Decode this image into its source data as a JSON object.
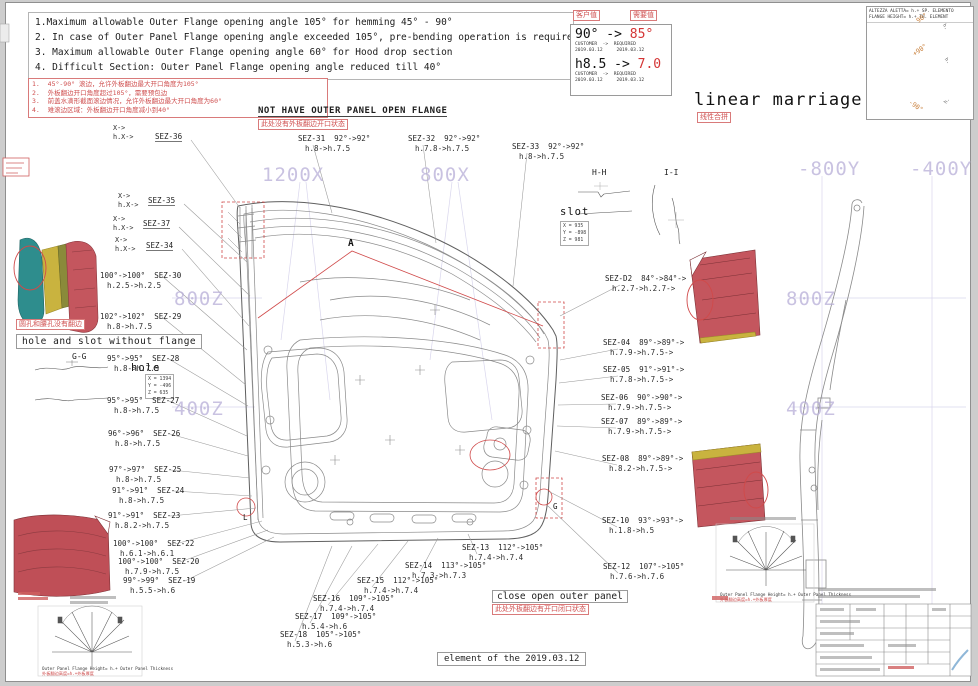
{
  "notes_en": {
    "l1": "1.Maximum allowable Outer Flange opening angle 105° for hemming 45° - 90°",
    "l2": "2. In case of Outer Panel Flange opening angle exceeded 105°, pre-bending operation is required",
    "l3": "3. Maximum allowable Outer Flange opening angle 60° for Hood drop section",
    "l4": "4. Difficult Section: Outer Panel Flange opening angle reduced till 40°"
  },
  "notes_cn": {
    "l1": "1.  45°-90° 滚边，允许外板翻边最大开口角度为105°",
    "l2": "2.  外板翻边开口角度超过105°，需要预包边",
    "l3": "3.  前盖水滴形截面滚边情况，允许外板翻边最大开口角度为60°",
    "l4": "4.  难滚边区域：外板翻边开口角度减小到40°"
  },
  "change_box": {
    "tag_old": "客户值",
    "tag_new": "需要值",
    "angle_old": "90°",
    "angle_arrow": " -> ",
    "angle_new": "85°",
    "meta1": "CUSTOMER  ->  REQUIRED",
    "meta2": "2019.03.12     2019.03.12",
    "height_old": "h8.5",
    "height_arrow": " -> ",
    "height_new": "7.0"
  },
  "titles": {
    "linear_marriage": "linear marriage",
    "linear_marriage_cn": "线性合拼",
    "not_have_flange": "NOT HAVE OUTER PANEL OPEN FLANGE",
    "not_have_flange_cn": "此处没有外板翻边开口状态",
    "hole_slot": "hole and slot without flange",
    "hole_slot_cn": "圆孔和腰孔没有翻边",
    "close_open": "close open outer panel",
    "close_open_cn": "此处外板翻边有开口闭口状态",
    "element_of": "element of the 2019.03.12"
  },
  "flange_legend": {
    "line1": "ALTEZZA ALETTA= h.+ SP. ELEMENTO",
    "line2": "FLANGE HEIGHT= h.+ TH. ELEMENT",
    "ang1": "90°",
    "ang2": "+90°",
    "ang3": "-90°",
    "h": "h."
  },
  "fan_caption": {
    "en": "Outer Panel Flange Height= h.+ Outer Panel Thickness",
    "cn": "外板翻边高度=h.+外板厚度"
  },
  "sections": {
    "gg": "G-G",
    "hh": "H-H",
    "ii": "I-I",
    "hole_title": "hole",
    "hole_x": "X = 1394",
    "hole_y": "Y = -496",
    "hole_z": "Z = 635",
    "slot_title": "slot",
    "slot_x": "X = 935",
    "slot_y": "Y = -898",
    "slot_z": "Z = 981"
  },
  "markers": {
    "a": "A",
    "g": "G",
    "l": "L"
  },
  "grid_labels": [
    {
      "text": "1200X",
      "x": 262,
      "y": 164
    },
    {
      "text": "800X",
      "x": 420,
      "y": 164
    },
    {
      "text": "-800Y",
      "x": 798,
      "y": 158
    },
    {
      "text": "-400Y",
      "x": 910,
      "y": 158
    },
    {
      "text": "800Z",
      "x": 174,
      "y": 288
    },
    {
      "text": "400Z",
      "x": 174,
      "y": 398
    },
    {
      "text": "800Z",
      "x": 786,
      "y": 288
    },
    {
      "text": "400Z",
      "x": 786,
      "y": 398
    }
  ],
  "x_labels": [
    {
      "x": 113,
      "y": 124,
      "l1": "X->",
      "l2": "h.X->"
    },
    {
      "x": 118,
      "y": 192,
      "l1": "X->",
      "l2": "h.X->"
    },
    {
      "x": 113,
      "y": 215,
      "l1": "X->",
      "l2": "h.X->"
    },
    {
      "x": 115,
      "y": 236,
      "l1": "X->",
      "l2": "h.X->"
    }
  ],
  "sez_labels": [
    {
      "id": "SEZ-36",
      "x": 155,
      "y": 132,
      "side": "O",
      "a1": "",
      "a2": "",
      "h1": "",
      "h2": "",
      "lx": 240,
      "ly": 208
    },
    {
      "id": "SEZ-35",
      "x": 148,
      "y": 196,
      "side": "O",
      "a1": "",
      "a2": "",
      "h1": "",
      "h2": "",
      "lx": 247,
      "ly": 262
    },
    {
      "id": "SEZ-37",
      "x": 143,
      "y": 219,
      "side": "O",
      "a1": "",
      "a2": "",
      "h1": "",
      "h2": "",
      "lx": 250,
      "ly": 296
    },
    {
      "id": "SEZ-34",
      "x": 146,
      "y": 241,
      "side": "O",
      "a1": "",
      "a2": "",
      "h1": "",
      "h2": "",
      "lx": 249,
      "ly": 326
    },
    {
      "id": "SEZ-31",
      "x": 298,
      "y": 134,
      "side": "L",
      "a1": "92°->",
      "a2": "92°",
      "h1": "h.8->",
      "h2": "h.7.5",
      "lx": 332,
      "ly": 213
    },
    {
      "id": "SEZ-32",
      "x": 408,
      "y": 134,
      "side": "L",
      "a1": "92°->",
      "a2": "92°",
      "h1": "h.7.8->",
      "h2": "h.7.5",
      "lx": 436,
      "ly": 243
    },
    {
      "id": "SEZ-33",
      "x": 512,
      "y": 142,
      "side": "L",
      "a1": "92°->",
      "a2": "92°",
      "h1": "h.8->",
      "h2": "h.7.5",
      "lx": 513,
      "ly": 286
    },
    {
      "id": "SEZ-30",
      "x": 100,
      "y": 271,
      "side": "R",
      "a1": "100°->",
      "a2": "100°",
      "h1": "h.2.5->",
      "h2": "h.2.5",
      "lx": 247,
      "ly": 350
    },
    {
      "id": "SEZ-29",
      "x": 100,
      "y": 312,
      "side": "R",
      "a1": "102°->",
      "a2": "102°",
      "h1": "h.8->",
      "h2": "h.7.5",
      "lx": 246,
      "ly": 385
    },
    {
      "id": "SEZ-28",
      "x": 107,
      "y": 354,
      "side": "R",
      "a1": "95°->",
      "a2": "95°",
      "h1": "h.8->",
      "h2": "h.7.5",
      "lx": 248,
      "ly": 406
    },
    {
      "id": "SEZ-27",
      "x": 107,
      "y": 396,
      "side": "R",
      "a1": "95°->",
      "a2": "95°",
      "h1": "h.8->",
      "h2": "h.7.5",
      "lx": 247,
      "ly": 436
    },
    {
      "id": "SEZ-26",
      "x": 108,
      "y": 429,
      "side": "R",
      "a1": "96°->",
      "a2": "96°",
      "h1": "h.8->",
      "h2": "h.7.5",
      "lx": 248,
      "ly": 456
    },
    {
      "id": "SEZ-25",
      "x": 109,
      "y": 465,
      "side": "R",
      "a1": "97°->",
      "a2": "97°",
      "h1": "h.8->",
      "h2": "h.7.5",
      "lx": 250,
      "ly": 478
    },
    {
      "id": "SEZ-24",
      "x": 112,
      "y": 486,
      "side": "R",
      "a1": "91°->",
      "a2": "91°",
      "h1": "h.8->",
      "h2": "h.7.5",
      "lx": 252,
      "ly": 496
    },
    {
      "id": "SEZ-23",
      "x": 108,
      "y": 511,
      "side": "R",
      "a1": "91°->",
      "a2": "91°",
      "h1": "h.8.2->",
      "h2": "h.7.5",
      "lx": 256,
      "ly": 508
    },
    {
      "id": "SEZ-22",
      "x": 113,
      "y": 539,
      "side": "R",
      "a1": "100°->",
      "a2": "100°",
      "h1": "h.6.1->",
      "h2": "h.6.1",
      "lx": 262,
      "ly": 521
    },
    {
      "id": "SEZ-20",
      "x": 118,
      "y": 557,
      "side": "R",
      "a1": "100°->",
      "a2": "100°",
      "h1": "h.7.9->",
      "h2": "h.7.5",
      "lx": 268,
      "ly": 530
    },
    {
      "id": "SEZ-19",
      "x": 123,
      "y": 576,
      "side": "R",
      "a1": "99°->",
      "a2": "99°",
      "h1": "h.5.5->",
      "h2": "h.6",
      "lx": 274,
      "ly": 537
    },
    {
      "id": "SEZ-18",
      "x": 280,
      "y": 630,
      "side": "L",
      "a1": "105°->",
      "a2": "105°",
      "h1": "h.5.3->",
      "h2": "h.6",
      "lx": 332,
      "ly": 546
    },
    {
      "id": "SEZ-17",
      "x": 295,
      "y": 612,
      "side": "L",
      "a1": "109°->",
      "a2": "105°",
      "h1": "h.5.4->",
      "h2": "h.6",
      "lx": 352,
      "ly": 546
    },
    {
      "id": "SEZ-16",
      "x": 313,
      "y": 594,
      "side": "L",
      "a1": "109°->",
      "a2": "105°",
      "h1": "h.7.4->",
      "h2": "h.7.4",
      "lx": 378,
      "ly": 544
    },
    {
      "id": "SEZ-15",
      "x": 357,
      "y": 576,
      "side": "L",
      "a1": "112°->",
      "a2": "105°",
      "h1": "h.7.4->",
      "h2": "h.7.4",
      "lx": 408,
      "ly": 541
    },
    {
      "id": "SEZ-14",
      "x": 405,
      "y": 561,
      "side": "L",
      "a1": "113°->",
      "a2": "105°",
      "h1": "h.7.3->",
      "h2": "h.7.3",
      "lx": 438,
      "ly": 538
    },
    {
      "id": "SEZ-13",
      "x": 462,
      "y": 543,
      "side": "L",
      "a1": "112°->",
      "a2": "105°",
      "h1": "h.7.4->",
      "h2": "h.7.4",
      "lx": 468,
      "ly": 534
    },
    {
      "id": "SEZ-D2",
      "x": 605,
      "y": 274,
      "side": "L",
      "a1": "84°->",
      "a2": "84°->",
      "h1": "h.2.7->",
      "h2": "h.2.7->",
      "lx": 560,
      "ly": 316
    },
    {
      "id": "SEZ-04",
      "x": 603,
      "y": 338,
      "side": "L",
      "a1": "89°->",
      "a2": "89°->",
      "h1": "h.7.9->",
      "h2": "h.7.5->",
      "lx": 560,
      "ly": 360
    },
    {
      "id": "SEZ-05",
      "x": 603,
      "y": 365,
      "side": "L",
      "a1": "91°->",
      "a2": "91°->",
      "h1": "h.7.8->",
      "h2": "h.7.5->",
      "lx": 559,
      "ly": 383
    },
    {
      "id": "SEZ-06",
      "x": 601,
      "y": 393,
      "side": "L",
      "a1": "90°->",
      "a2": "90°->",
      "h1": "h.7.9->",
      "h2": "h.7.5->",
      "lx": 558,
      "ly": 405
    },
    {
      "id": "SEZ-07",
      "x": 601,
      "y": 417,
      "side": "L",
      "a1": "89°->",
      "a2": "89°->",
      "h1": "h.7.9->",
      "h2": "h.7.5->",
      "lx": 557,
      "ly": 426
    },
    {
      "id": "SEZ-08",
      "x": 602,
      "y": 454,
      "side": "L",
      "a1": "89°->",
      "a2": "89°->",
      "h1": "h.8.2->",
      "h2": "h.7.5->",
      "lx": 555,
      "ly": 451
    },
    {
      "id": "SEZ-10",
      "x": 602,
      "y": 516,
      "side": "L",
      "a1": "93°->",
      "a2": "93°->",
      "h1": "h.1.8->",
      "h2": "h.5",
      "lx": 550,
      "ly": 492
    },
    {
      "id": "SEZ-12",
      "x": 603,
      "y": 562,
      "side": "L",
      "a1": "107°->",
      "a2": "105°",
      "h1": "h.7.6->",
      "h2": "h.7.6",
      "lx": 548,
      "ly": 506
    }
  ]
}
